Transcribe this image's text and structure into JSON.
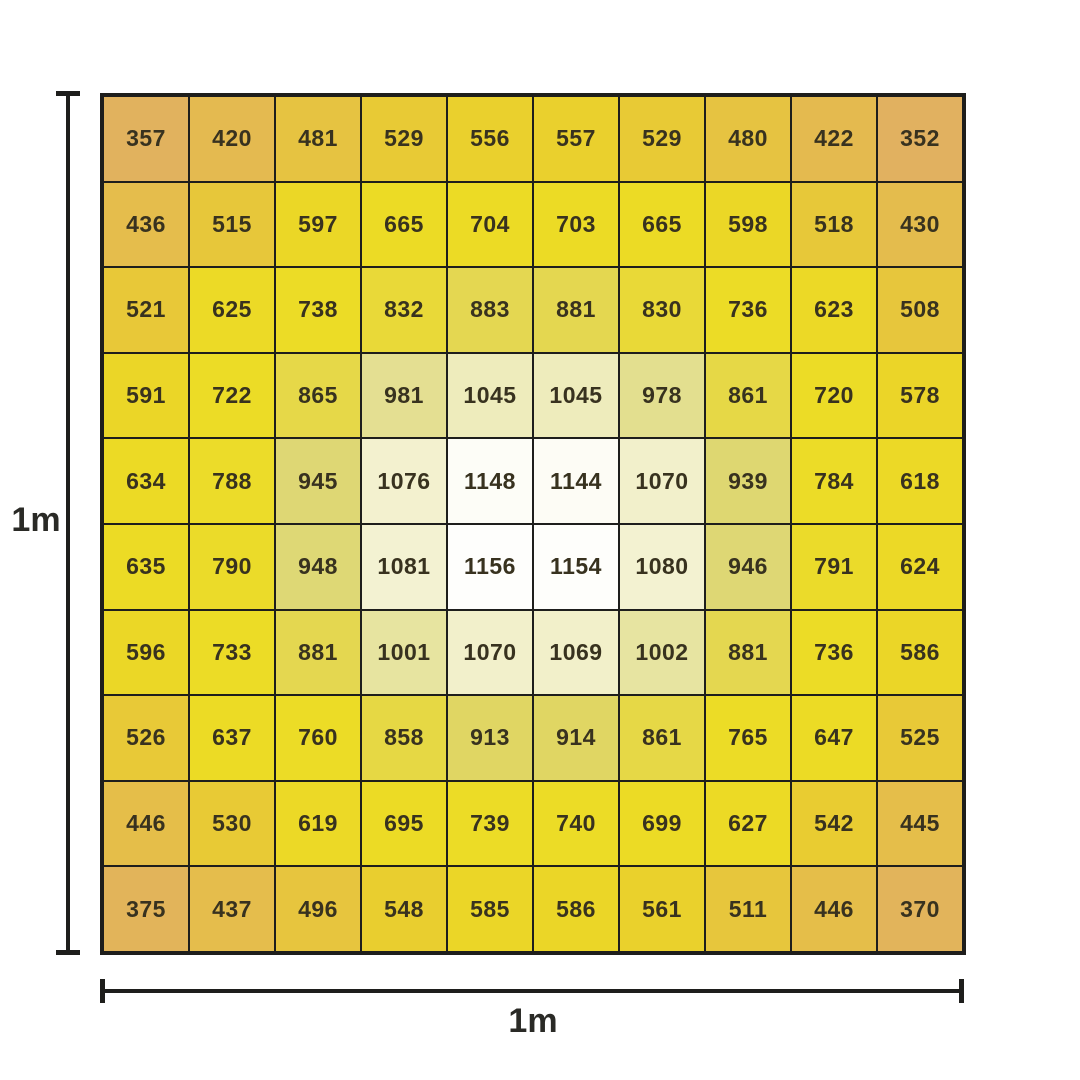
{
  "chart_data": {
    "type": "heatmap",
    "title": "",
    "rows": 10,
    "cols": 10,
    "left_dimension_label": "1m",
    "bottom_dimension_label": "1m",
    "value_min": 352,
    "value_max": 1156,
    "values": [
      [
        357,
        420,
        481,
        529,
        556,
        557,
        529,
        480,
        422,
        352
      ],
      [
        436,
        515,
        597,
        665,
        704,
        703,
        665,
        598,
        518,
        430
      ],
      [
        521,
        625,
        738,
        832,
        883,
        881,
        830,
        736,
        623,
        508
      ],
      [
        591,
        722,
        865,
        981,
        1045,
        1045,
        978,
        861,
        720,
        578
      ],
      [
        634,
        788,
        945,
        1076,
        1148,
        1144,
        1070,
        939,
        784,
        618
      ],
      [
        635,
        790,
        948,
        1081,
        1156,
        1154,
        1080,
        946,
        791,
        624
      ],
      [
        596,
        733,
        881,
        1001,
        1070,
        1069,
        1002,
        881,
        736,
        586
      ],
      [
        526,
        637,
        760,
        858,
        913,
        914,
        861,
        765,
        647,
        525
      ],
      [
        446,
        530,
        619,
        695,
        739,
        740,
        699,
        627,
        542,
        445
      ],
      [
        375,
        437,
        496,
        548,
        585,
        586,
        561,
        511,
        446,
        370
      ]
    ],
    "grid_line_color": "#1e1e1c",
    "text_color": "#38321f",
    "color_scale": [
      {
        "value": 350,
        "color": "#e1b160"
      },
      {
        "value": 420,
        "color": "#e4ba50"
      },
      {
        "value": 470,
        "color": "#e6c243"
      },
      {
        "value": 510,
        "color": "#e7c63c"
      },
      {
        "value": 545,
        "color": "#e9cd30"
      },
      {
        "value": 580,
        "color": "#ebd527"
      },
      {
        "value": 640,
        "color": "#ecdb25"
      },
      {
        "value": 780,
        "color": "#ecdc26"
      },
      {
        "value": 830,
        "color": "#e9d937"
      },
      {
        "value": 880,
        "color": "#e4d74f"
      },
      {
        "value": 920,
        "color": "#dfd667"
      },
      {
        "value": 955,
        "color": "#ded879"
      },
      {
        "value": 990,
        "color": "#e6e29a"
      },
      {
        "value": 1015,
        "color": "#e9e6a8"
      },
      {
        "value": 1050,
        "color": "#efedbf"
      },
      {
        "value": 1085,
        "color": "#f4f3d4"
      },
      {
        "value": 1115,
        "color": "#f9f8e8"
      },
      {
        "value": 1148,
        "color": "#fdfdf7"
      },
      {
        "value": 1160,
        "color": "#ffffff"
      }
    ]
  }
}
